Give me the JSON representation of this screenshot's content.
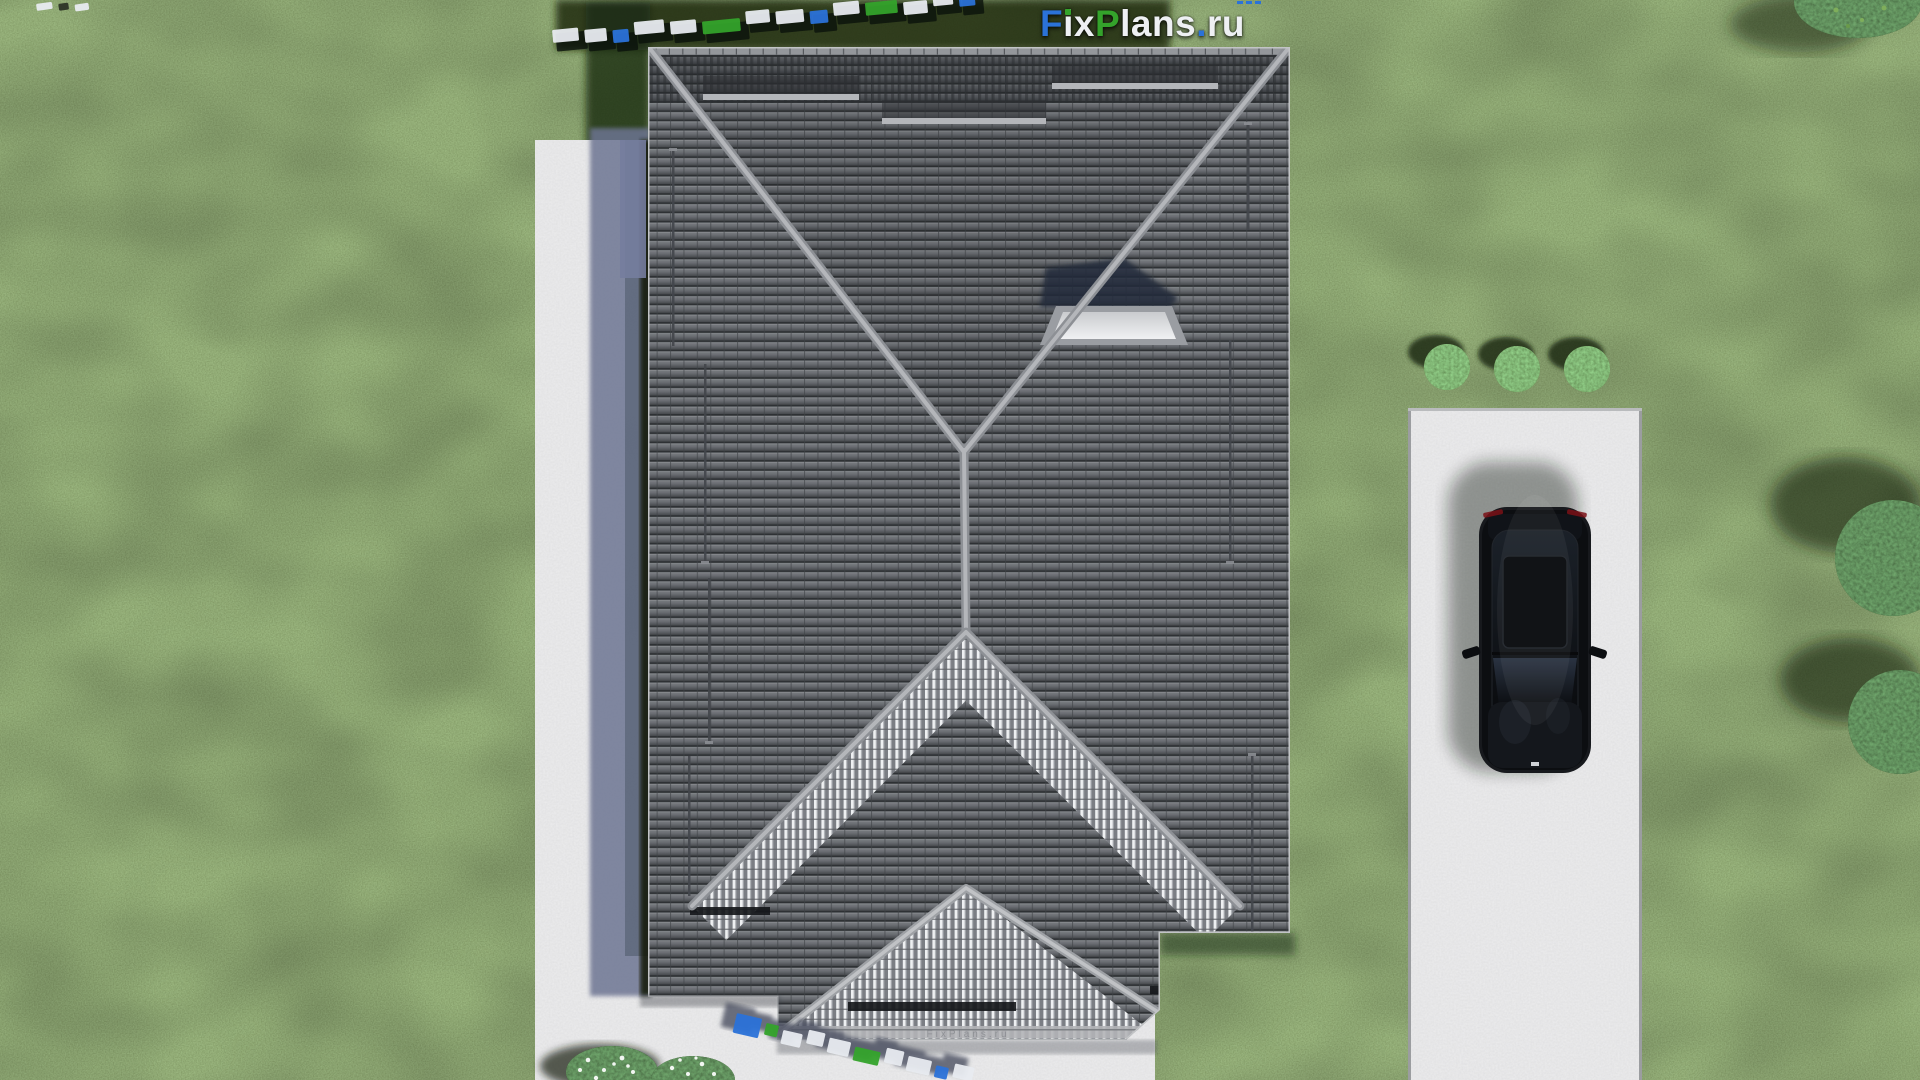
{
  "logo": {
    "f": "F",
    "i": "i",
    "x": "x",
    "p": "P",
    "lans": "lans",
    "dot": ".",
    "ru": "ru"
  },
  "fascia": {
    "text": "FixPlans.ru"
  },
  "palette": {
    "lawn": "#4b672f",
    "lawn_shadow": "#1c2913",
    "concrete": "#cbcccd",
    "concrete_shade": "#6d7492",
    "tile_gray": "#6e7176",
    "tile_gap": "#2e3134",
    "ridge_cap": "#b4b6ba",
    "stripe_light": "#eef0f2",
    "stripe_dark": "#7b7e84",
    "skylight_shadow": "#232c3a",
    "car_black": "#0c0e11",
    "foliage_dark": "#243616",
    "flower_white": "#ffffff",
    "logo_blue": "#2b72d8",
    "logo_green": "#34a32b",
    "logo_white": "#eef0f3",
    "wm_shadow": "#4a5060"
  },
  "watermarks": {
    "top": {
      "blocks": [
        {
          "c": "w",
          "w": 26
        },
        {
          "c": "w",
          "w": 22
        },
        {
          "c": "b",
          "w": 16
        },
        {
          "c": "w",
          "w": 30
        },
        {
          "c": "w",
          "w": 26
        },
        {
          "c": "g",
          "w": 38
        },
        {
          "c": "w",
          "w": 24
        },
        {
          "c": "w",
          "w": 28
        },
        {
          "c": "b",
          "w": 18
        },
        {
          "c": "w",
          "w": 26
        },
        {
          "c": "g",
          "w": 32
        },
        {
          "c": "w",
          "w": 24
        },
        {
          "c": "w",
          "w": 20
        },
        {
          "c": "b",
          "w": 16
        }
      ]
    },
    "corner": {
      "blocks": [
        {
          "c": "w",
          "w": 16
        },
        {
          "c": "d",
          "w": 10
        },
        {
          "c": "w",
          "w": 14
        }
      ]
    },
    "bottom": {
      "blocks": [
        {
          "c": "b",
          "w": 26,
          "h": 20
        },
        {
          "c": "g",
          "w": 13,
          "h": 12
        },
        {
          "c": "w",
          "w": 20,
          "h": 14
        },
        {
          "c": "w",
          "w": 17,
          "h": 14
        },
        {
          "c": "w",
          "w": 22,
          "h": 15
        },
        {
          "c": "g",
          "w": 26,
          "h": 14
        },
        {
          "c": "w",
          "w": 18,
          "h": 15
        },
        {
          "c": "w",
          "w": 24,
          "h": 15
        },
        {
          "c": "b",
          "w": 13,
          "h": 12
        },
        {
          "c": "w",
          "w": 20,
          "h": 14
        }
      ]
    }
  }
}
